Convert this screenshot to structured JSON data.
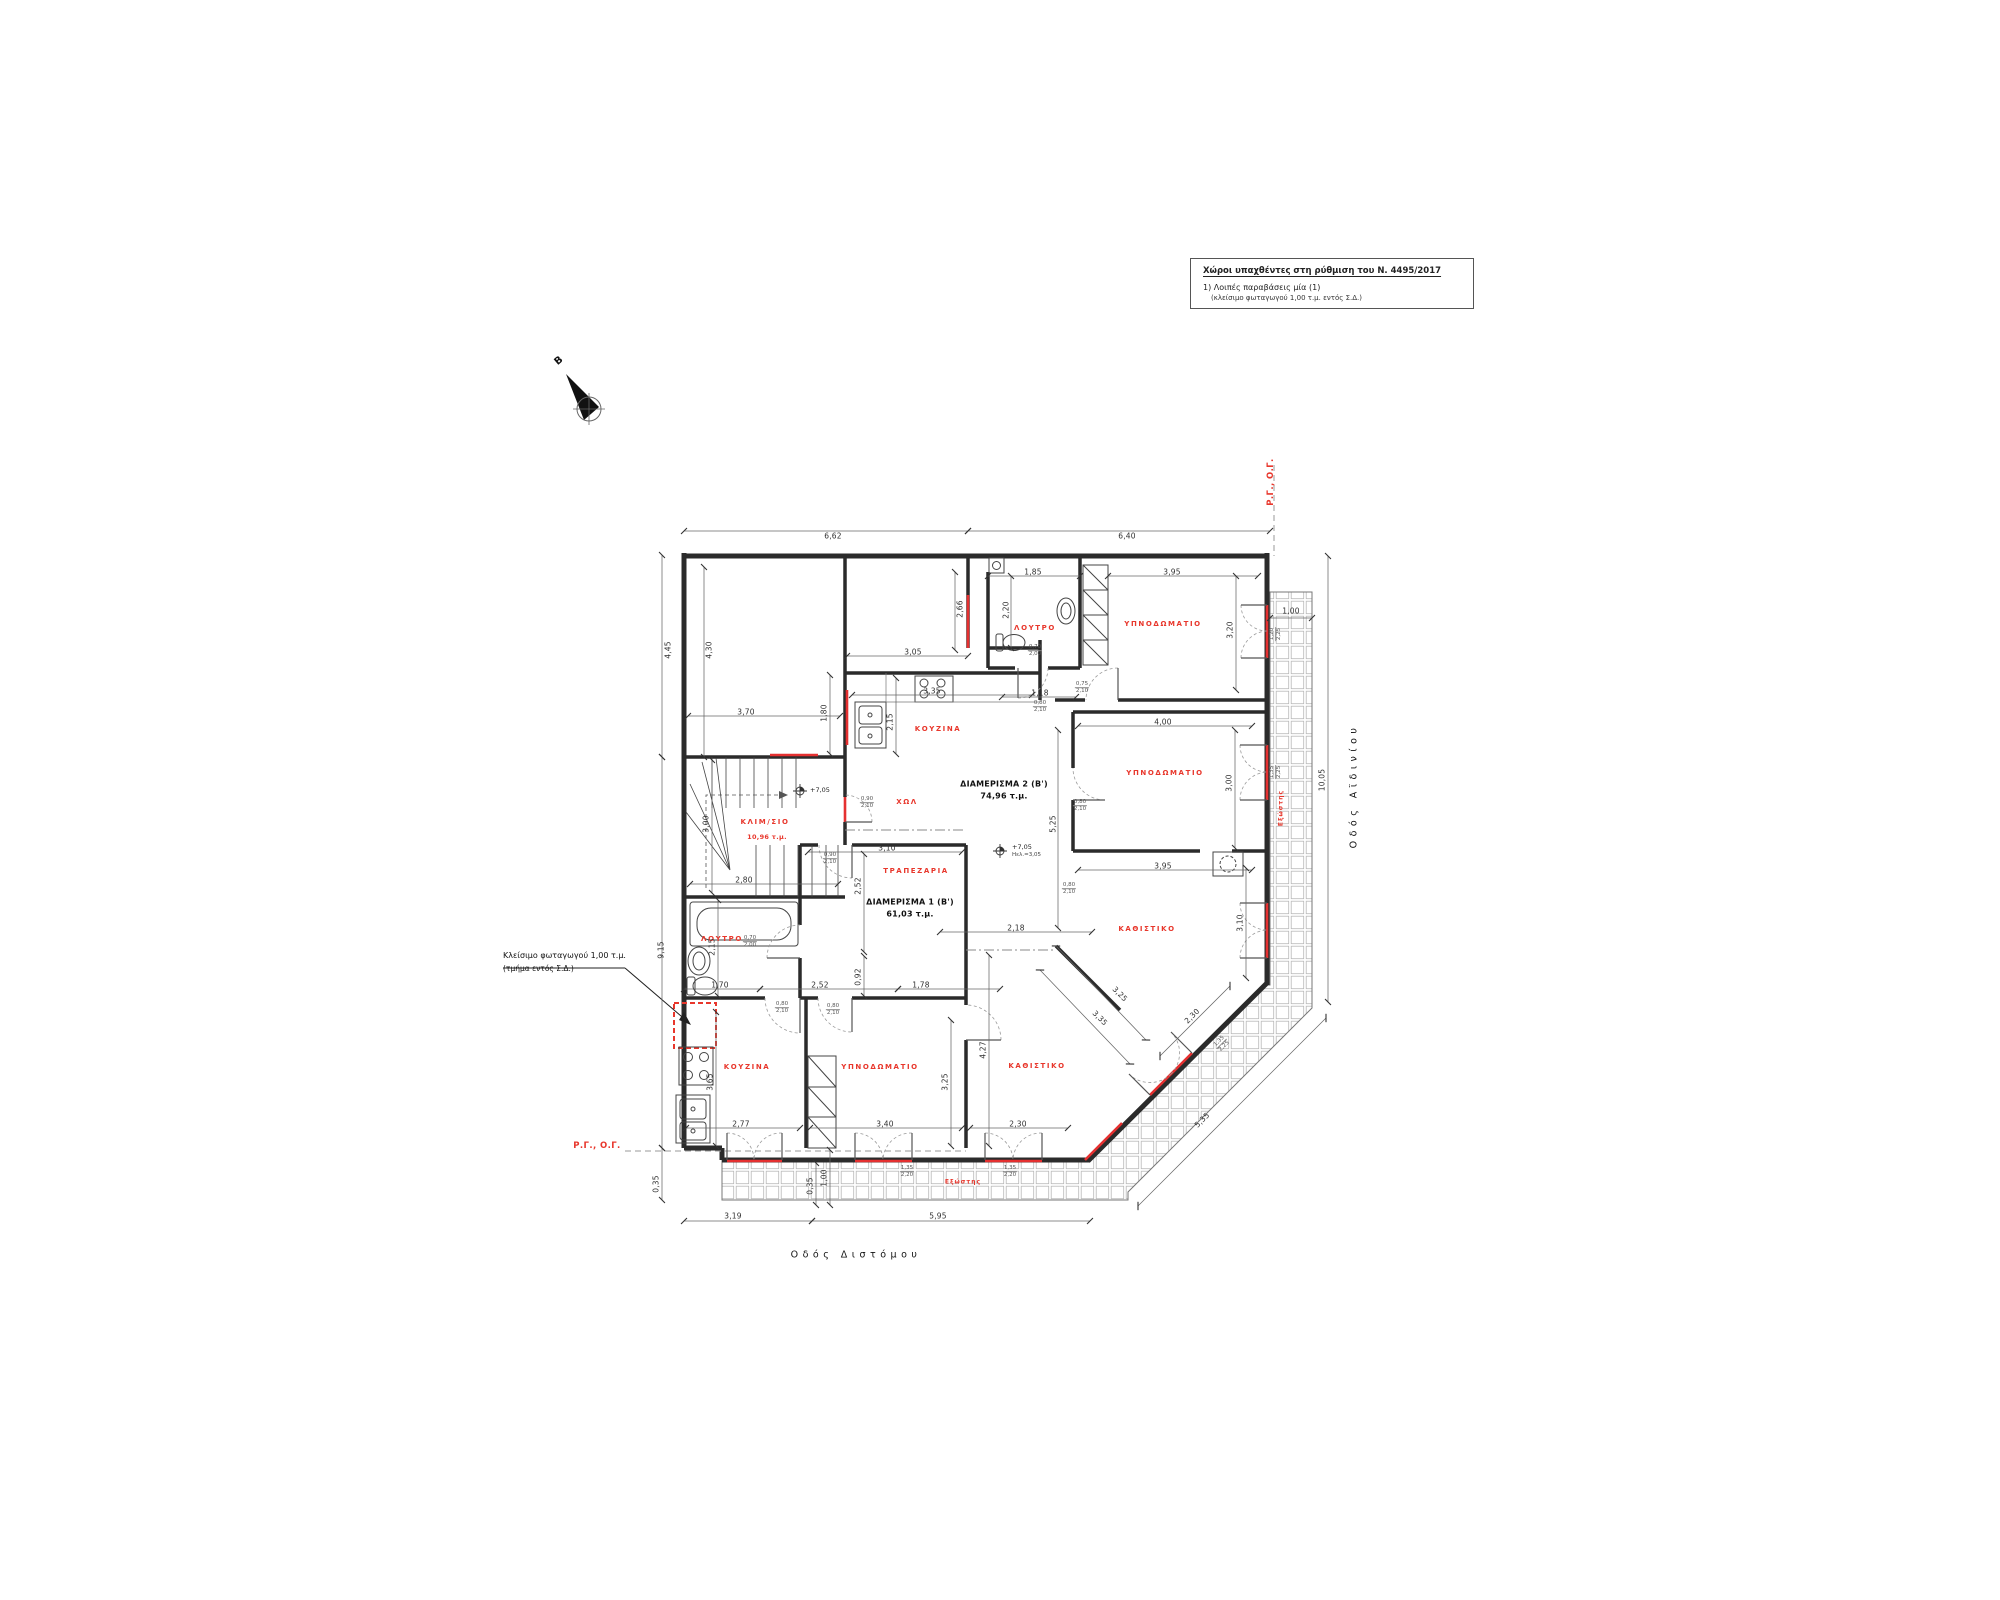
{
  "colors": {
    "accent_red": "#e8372c",
    "window_red": "#e53030",
    "ink": "#2b2b2b",
    "dim_line": "#666666",
    "tile": "#b8b8b8"
  },
  "legend": {
    "title": "Χώροι υπαχθέντες στη ρύθμιση του Ν. 4495/2017",
    "item1": "1) Λοιπές παραβάσεις μία (1)",
    "item2": "(κλείσιμο φωταγωγού 1,00 τ.μ. εντός Σ.Δ.)"
  },
  "north": {
    "label": "B"
  },
  "streets": {
    "bottom": {
      "text": "Οδός Διστόμου"
    },
    "right": {
      "text": "Οδός Αϊδινίου"
    }
  },
  "callout": {
    "line1": "Κλείσιμο φωταγωγού 1,00 τ.μ.",
    "line2": "(τμήμα εντός Σ.Δ.)"
  },
  "markers": [
    {
      "text": "Ρ.Γ., Ο.Γ.",
      "x": 1271,
      "y": 482,
      "rot": -90
    },
    {
      "text": "Ρ.Γ., Ο.Γ.",
      "x": 597,
      "y": 1146,
      "rot": 0
    }
  ],
  "plan": {
    "apartments": [
      {
        "label": "ΔΙΑΜΕΡΙΣΜΑ 2 (Β')",
        "area": "74,96 τ.μ.",
        "x": 1004,
        "y": 784,
        "ax": 1004,
        "ay": 796
      },
      {
        "label": "ΔΙΑΜΕΡΙΣΜΑ 1 (Β')",
        "area": "61,03 τ.μ.",
        "x": 910,
        "y": 902,
        "ax": 910,
        "ay": 914
      }
    ],
    "stair": {
      "label": "ΚΛΙΜ/ΣΙΟ",
      "x": 765,
      "y": 822,
      "area": "10,96 τ.μ.",
      "ax": 767,
      "ay": 837
    },
    "rooms": [
      {
        "label": "ΛΟΥΤΡΟ",
        "x": 1035,
        "y": 628
      },
      {
        "label": "ΥΠΝΟΔΩΜΑΤΙΟ",
        "x": 1163,
        "y": 624
      },
      {
        "label": "ΚΟΥΖΙΝΑ",
        "x": 938,
        "y": 729
      },
      {
        "label": "ΧΩΛ",
        "x": 907,
        "y": 802
      },
      {
        "label": "ΥΠΝΟΔΩΜΑΤΙΟ",
        "x": 1165,
        "y": 773
      },
      {
        "label": "ΚΑΘΙΣΤΙΚΟ",
        "x": 1147,
        "y": 929
      },
      {
        "label": "ΤΡΑΠΕΖΑΡΙΑ",
        "x": 916,
        "y": 871
      },
      {
        "label": "ΛΟΥΤΡΟ",
        "x": 722,
        "y": 939
      },
      {
        "label": "ΚΟΥΖΙΝΑ",
        "x": 747,
        "y": 1067
      },
      {
        "label": "ΥΠΝΟΔΩΜΑΤΙΟ",
        "x": 880,
        "y": 1067
      },
      {
        "label": "ΚΑΘΙΣΤΙΚΟ",
        "x": 1037,
        "y": 1066
      }
    ],
    "balcony_labels": [
      {
        "label": "Εξώστης",
        "x": 1281,
        "y": 808,
        "rot": -90
      },
      {
        "label": "Εξώστης",
        "x": 963,
        "y": 1182,
        "rot": 0
      }
    ],
    "levels": [
      {
        "text": "+7,05",
        "x": 810,
        "y": 791
      },
      {
        "text": "+7,05",
        "sub": "Ηελ.=3,05",
        "x": 1012,
        "y": 851
      }
    ],
    "dimensions": [
      {
        "v": "6,62",
        "t": [
          833,
          536
        ],
        "rot": 0,
        "l": [
          684,
          531,
          968,
          531
        ]
      },
      {
        "v": "6,40",
        "t": [
          1127,
          536
        ],
        "rot": 0,
        "l": [
          968,
          531,
          1270,
          531
        ]
      },
      {
        "v": "4,45",
        "t": [
          668,
          650
        ],
        "rot": -90,
        "l": [
          662,
          555,
          662,
          757
        ]
      },
      {
        "v": "9,15",
        "t": [
          661,
          950
        ],
        "rot": -90,
        "l": [
          662,
          757,
          662,
          1148
        ]
      },
      {
        "v": "0,35",
        "t": [
          656,
          1184
        ],
        "rot": -90,
        "l": [
          662,
          1148,
          662,
          1200
        ]
      },
      {
        "v": "4,30",
        "t": [
          709,
          650
        ],
        "rot": -90,
        "l": [
          704,
          567,
          704,
          757
        ]
      },
      {
        "v": "1,85",
        "t": [
          1033,
          572
        ],
        "rot": 0,
        "l": [
          988,
          576,
          1080,
          576
        ]
      },
      {
        "v": "3,95",
        "t": [
          1172,
          572
        ],
        "rot": 0,
        "l": [
          1108,
          576,
          1258,
          576
        ]
      },
      {
        "v": "1,00",
        "t": [
          1291,
          611
        ],
        "rot": 0,
        "l": [
          1270,
          618,
          1312,
          618
        ]
      },
      {
        "v": "3,20",
        "t": [
          1230,
          630
        ],
        "rot": -90,
        "l": [
          1236,
          576,
          1236,
          690
        ]
      },
      {
        "v": "2,66",
        "t": [
          960,
          609
        ],
        "rot": -90,
        "l": [
          955,
          572,
          955,
          650
        ]
      },
      {
        "v": "2,20",
        "t": [
          1006,
          610
        ],
        "rot": -90,
        "l": [
          1011,
          576,
          1011,
          648
        ]
      },
      {
        "v": "3,05",
        "t": [
          913,
          652
        ],
        "rot": 0,
        "l": [
          847,
          656,
          968,
          656
        ]
      },
      {
        "v": "3,70",
        "t": [
          746,
          712
        ],
        "rot": 0,
        "l": [
          688,
          716,
          840,
          716
        ]
      },
      {
        "v": "1,80",
        "t": [
          824,
          713
        ],
        "rot": -90,
        "l": [
          830,
          675,
          830,
          754
        ]
      },
      {
        "v": "2,15",
        "t": [
          890,
          722
        ],
        "rot": -90,
        "l": [
          896,
          678,
          896,
          754
        ]
      },
      {
        "v": "3,35",
        "t": [
          932,
          691
        ],
        "rot": 0,
        "l": [
          852,
          695,
          1032,
          695
        ]
      },
      {
        "v": "1,18",
        "t": [
          1040,
          693
        ],
        "rot": 0,
        "l": [
          1002,
          697,
          1076,
          697
        ]
      },
      {
        "v": "4,00",
        "t": [
          1163,
          722
        ],
        "rot": 0,
        "l": [
          1078,
          726,
          1252,
          726
        ]
      },
      {
        "v": "3,00",
        "t": [
          1229,
          783
        ],
        "rot": -90,
        "l": [
          1235,
          730,
          1235,
          848
        ]
      },
      {
        "v": "10,05",
        "t": [
          1322,
          780
        ],
        "rot": -90,
        "l": [
          1328,
          556,
          1328,
          1002
        ]
      },
      {
        "v": "5,25",
        "t": [
          1053,
          824
        ],
        "rot": -90,
        "l": [
          1058,
          730,
          1058,
          928
        ]
      },
      {
        "v": "3,10",
        "t": [
          887,
          848
        ],
        "rot": 0,
        "l": [
          808,
          852,
          962,
          852
        ]
      },
      {
        "v": "2,80",
        "t": [
          744,
          880
        ],
        "rot": 0,
        "l": [
          690,
          884,
          838,
          884
        ]
      },
      {
        "v": "3,00",
        "t": [
          706,
          824
        ],
        "rot": -90,
        "l": [
          712,
          760,
          712,
          893
        ]
      },
      {
        "v": "2,52",
        "t": [
          858,
          886
        ],
        "rot": -90,
        "l": [
          864,
          854,
          864,
          952
        ]
      },
      {
        "v": "0,92",
        "t": [
          858,
          977
        ],
        "rot": -90,
        "l": [
          864,
          956,
          864,
          996
        ]
      },
      {
        "v": "3,95",
        "t": [
          1163,
          866
        ],
        "rot": 0,
        "l": [
          1078,
          870,
          1252,
          870
        ]
      },
      {
        "v": "2,18",
        "t": [
          1016,
          928
        ],
        "rot": 0,
        "l": [
          940,
          932,
          1092,
          932
        ]
      },
      {
        "v": "3,10",
        "t": [
          1240,
          923
        ],
        "rot": -90,
        "l": [
          1246,
          868,
          1246,
          978
        ]
      },
      {
        "v": "2,15",
        "t": [
          712,
          947
        ],
        "rot": -90,
        "l": [
          718,
          900,
          718,
          996
        ]
      },
      {
        "v": "1,70",
        "t": [
          720,
          985
        ],
        "rot": 0,
        "l": [
          684,
          989,
          760,
          989
        ]
      },
      {
        "v": "2,52",
        "t": [
          820,
          985
        ],
        "rot": 0,
        "l": [
          760,
          989,
          898,
          989
        ]
      },
      {
        "v": "1,78",
        "t": [
          921,
          985
        ],
        "rot": 0,
        "l": [
          898,
          989,
          1000,
          989
        ]
      },
      {
        "v": "3,65",
        "t": [
          710,
          1082
        ],
        "rot": -90,
        "l": [
          716,
          1012,
          716,
          1146
        ]
      },
      {
        "v": "3,25",
        "t": [
          945,
          1082
        ],
        "rot": -90,
        "l": [
          951,
          1020,
          951,
          1146
        ]
      },
      {
        "v": "4,27",
        "t": [
          983,
          1050
        ],
        "rot": -90,
        "l": [
          989,
          955,
          989,
          1146
        ]
      },
      {
        "v": "2,77",
        "t": [
          741,
          1124
        ],
        "rot": 0,
        "l": [
          686,
          1128,
          800,
          1128
        ]
      },
      {
        "v": "3,40",
        "t": [
          885,
          1124
        ],
        "rot": 0,
        "l": [
          810,
          1128,
          962,
          1128
        ]
      },
      {
        "v": "2,30",
        "t": [
          1018,
          1124
        ],
        "rot": 0,
        "l": [
          970,
          1128,
          1068,
          1128
        ]
      },
      {
        "v": "3,19",
        "t": [
          733,
          1216
        ],
        "rot": 0,
        "l": [
          684,
          1221,
          812,
          1221
        ]
      },
      {
        "v": "5,95",
        "t": [
          938,
          1216
        ],
        "rot": 0,
        "l": [
          812,
          1221,
          1090,
          1221
        ]
      },
      {
        "v": "5,35",
        "t": [
          1202,
          1120
        ],
        "rot": -45,
        "l": [
          1138,
          1206,
          1326,
          1018
        ]
      },
      {
        "v": "3,25",
        "t": [
          1120,
          994
        ],
        "rot": 45,
        "l": [
          1056,
          946,
          1146,
          1040
        ]
      },
      {
        "v": "3,35",
        "t": [
          1100,
          1018
        ],
        "rot": 45,
        "l": [
          1040,
          970,
          1130,
          1064
        ]
      },
      {
        "v": "2,30",
        "t": [
          1192,
          1016
        ],
        "rot": -45,
        "l": [
          1160,
          1056,
          1230,
          986
        ]
      },
      {
        "v": "1,00",
        "t": [
          824,
          1178
        ],
        "rot": -90,
        "l": [
          830,
          1150,
          830,
          1205
        ]
      },
      {
        "v": "0,35",
        "t": [
          810,
          1186
        ],
        "rot": -90,
        "l": [
          816,
          1163,
          816,
          1205
        ]
      }
    ],
    "openings": [
      {
        "top": "0,70",
        "bot": "2,00",
        "x": 1035,
        "y": 651,
        "rot": 0
      },
      {
        "top": "0,75",
        "bot": "2,10",
        "x": 1082,
        "y": 688,
        "rot": 0
      },
      {
        "top": "0,80",
        "bot": "2,10",
        "x": 1040,
        "y": 707,
        "rot": 0
      },
      {
        "top": "0,90",
        "bot": "2,10",
        "x": 867,
        "y": 803,
        "rot": 0
      },
      {
        "top": "0,90",
        "bot": "2,10",
        "x": 830,
        "y": 859,
        "rot": 0
      },
      {
        "top": "0,80",
        "bot": "2,10",
        "x": 1069,
        "y": 889,
        "rot": 0
      },
      {
        "top": "0,80",
        "bot": "2,10",
        "x": 1080,
        "y": 806,
        "rot": 0
      },
      {
        "top": "0,70",
        "bot": "2,00",
        "x": 750,
        "y": 942,
        "rot": 0
      },
      {
        "top": "0,80",
        "bot": "2,10",
        "x": 782,
        "y": 1008,
        "rot": 0
      },
      {
        "top": "0,80",
        "bot": "2,10",
        "x": 833,
        "y": 1010,
        "rot": 0
      },
      {
        "top": "1,20",
        "bot": "2,25",
        "x": 1276,
        "y": 634,
        "rot": -90
      },
      {
        "top": "1,35",
        "bot": "2,25",
        "x": 1276,
        "y": 772,
        "rot": -90
      },
      {
        "top": "1,35",
        "bot": "2,20",
        "x": 907,
        "y": 1172,
        "rot": 0
      },
      {
        "top": "1,35",
        "bot": "2,20",
        "x": 1010,
        "y": 1172,
        "rot": 0
      },
      {
        "top": "1,35",
        "bot": "2,25",
        "x": 1222,
        "y": 1044,
        "rot": -45
      }
    ]
  }
}
